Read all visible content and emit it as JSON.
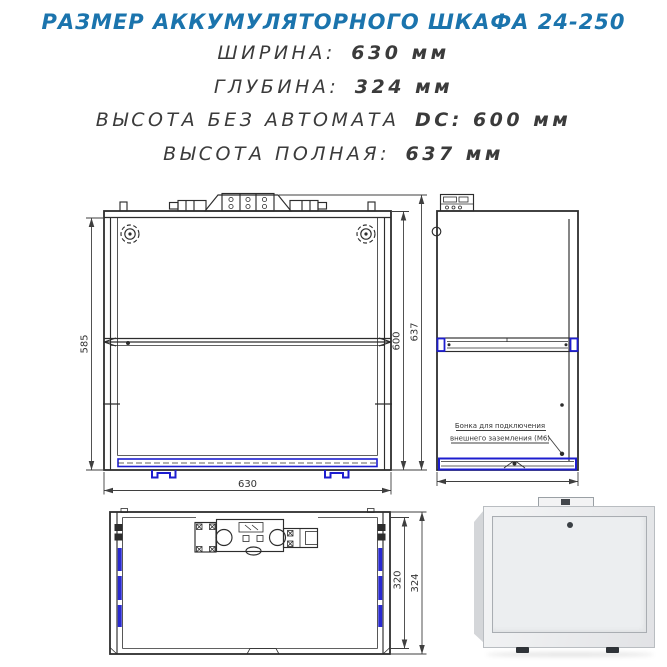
{
  "header": {
    "title": "РАЗМЕР АККУМУЛЯТОРНОГО ШКАФА 24-250",
    "specs": [
      {
        "label": "ШИРИНА:",
        "value": "630 мм"
      },
      {
        "label": "ГЛУБИНА:",
        "value": "324 мм"
      },
      {
        "label": "ВЫСОТА БЕЗ АВТОМАТА",
        "value": "DC: 600 мм"
      },
      {
        "label": "ВЫСОТА ПОЛНАЯ:",
        "value": "637 мм"
      }
    ]
  },
  "drawings": {
    "front_view": {
      "dim_left": "585",
      "dim_right_inner": "600",
      "dim_right_outer": "637",
      "dim_bottom": "630"
    },
    "side_view": {
      "annotation_line1": "Бонка для подключения",
      "annotation_line2": "внешнего заземления (М6)"
    },
    "top_view": {
      "dim_depth_inner": "320",
      "dim_depth_outer": "324"
    }
  },
  "colors": {
    "accent_blue": "#1b74ad",
    "drawing_blue": "#1d1dcf",
    "line_dark": "#2d2d2d"
  }
}
